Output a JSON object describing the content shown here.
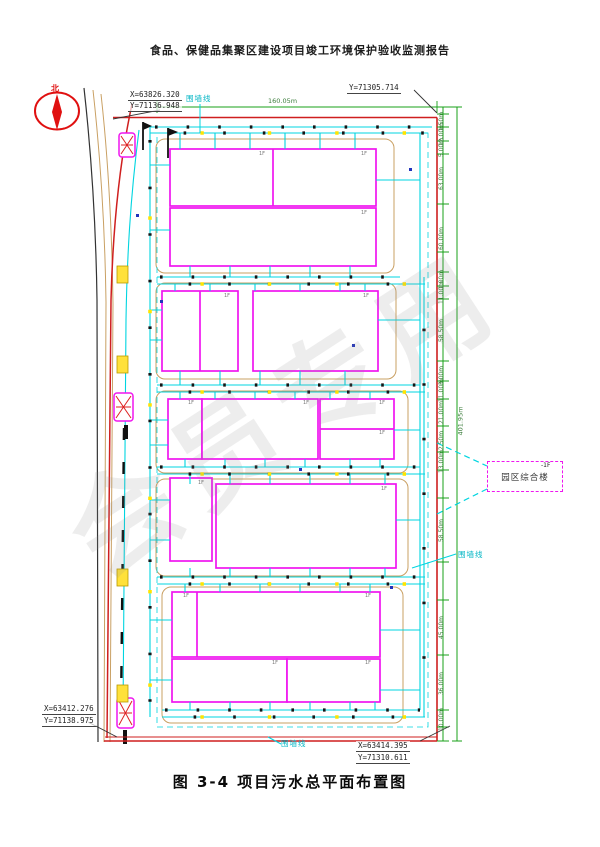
{
  "page": {
    "header_title": "食品、保健品集聚区建设项目竣工环境保护验收监测报告",
    "caption": "图 3-4 项目污水总平面布置图",
    "watermark": "会员专用"
  },
  "compass": {
    "north_label": "北"
  },
  "coordinates": {
    "top_left_x": "X=63826.320",
    "top_left_y": "Y=71136.948",
    "top_right_y": "Y=71305.714",
    "bottom_left_x": "X=63412.276",
    "bottom_left_y": "Y=71138.975",
    "bottom_right_x": "X=63414.395",
    "bottom_right_y": "Y=71310.611"
  },
  "labels": {
    "fence_top": "围墙线",
    "fence_right": "围墙线",
    "fence_bottom": "围墙线",
    "annex_building": "园区综合楼",
    "annex_floor": "-1F",
    "floor_marker": "1F"
  },
  "dimensions": {
    "top_width": "160.05m",
    "right_total": "401.95m",
    "right_segments": [
      "1.50m",
      "12.00m",
      "5.00m",
      "63.00m",
      "60.00m",
      "1.00m",
      "11.00m",
      "58.50m",
      "3.00m",
      "11.00m",
      "21.00m",
      "2.50m",
      "13.00m",
      "58.50m",
      "45.00m",
      "36.00m",
      "10.00m"
    ]
  },
  "colors": {
    "boundary_red": "#cf1f1f",
    "fence_green": "#18a018",
    "pipe_cyan": "#00d5e0",
    "building_magenta": "#ef16ef",
    "road_tan": "#c9a063",
    "basin_yellow": "#ffe400"
  }
}
